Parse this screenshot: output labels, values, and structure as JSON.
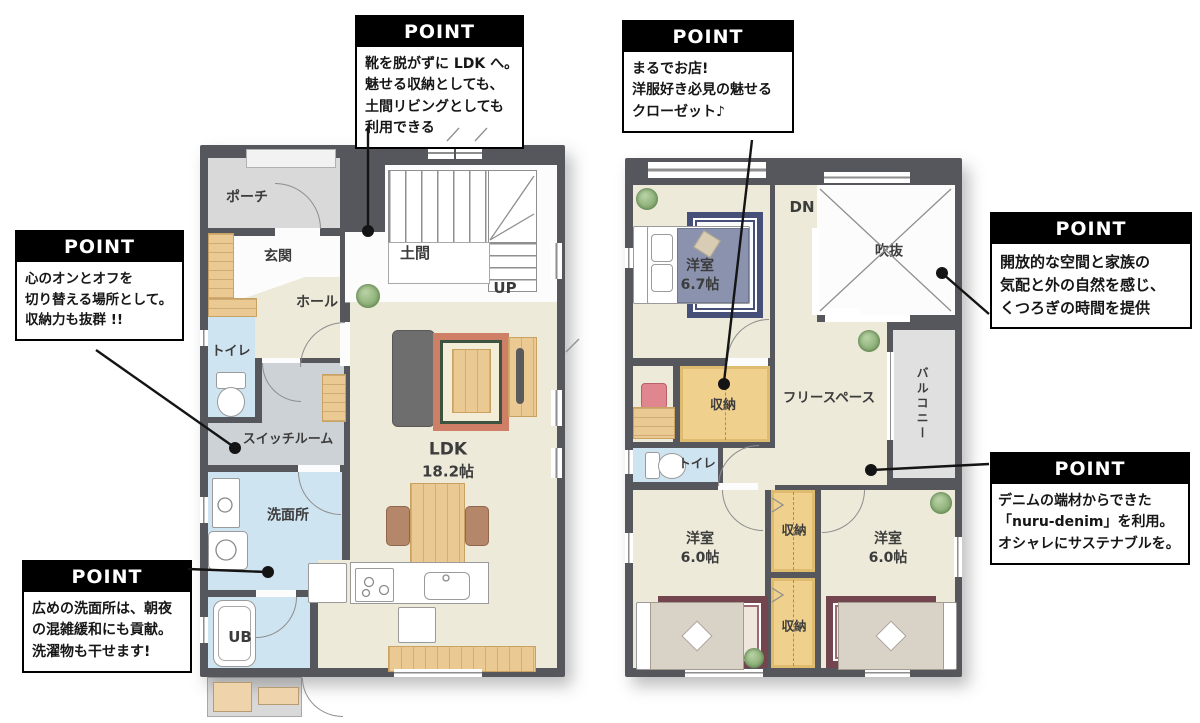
{
  "title": "2-story house floor plan",
  "floor1": {
    "labels": {
      "porch": "ポーチ",
      "genkan": "玄関",
      "doma": "土間",
      "hall": "ホール",
      "toilet": "トイレ",
      "switch_room": "スイッチルーム",
      "washroom": "洗面所",
      "ub": "UB",
      "ldk_name": "LDK",
      "ldk_size": "18.2帖",
      "up": "UP"
    }
  },
  "floor2": {
    "labels": {
      "dn": "DN",
      "void_space": "吹抜",
      "bedroom_main": "洋室",
      "bedroom_main_size": "6.7帖",
      "closet_main": "収納",
      "free_space": "フリースペース",
      "balcony": "バルコニー",
      "toilet": "トイレ",
      "bedroom_left": "洋室",
      "bedroom_left_size": "6.0帖",
      "closet_upper": "収納",
      "closet_lower": "収納",
      "bedroom_right": "洋室",
      "bedroom_right_size": "6.0帖"
    }
  },
  "callouts": [
    {
      "title": "POINT",
      "lines": [
        "靴を脱がずに LDK へ。",
        "魅せる収納としても、",
        "土間リビングとしても",
        "利用できる"
      ]
    },
    {
      "title": "POINT",
      "lines": [
        "心のオンとオフを",
        "切り替える場所として。",
        "収納力も抜群 !!"
      ]
    },
    {
      "title": "POINT",
      "lines": [
        "広めの洗面所は、朝夜",
        "の混雑緩和にも貢献。",
        "洗濯物も干せます!"
      ]
    },
    {
      "title": "POINT",
      "lines": [
        "まるでお店!",
        "洋服好き必見の魅せる",
        "クローゼット♪"
      ]
    },
    {
      "title": "POINT",
      "lines": [
        "開放的な空間と家族の",
        "気配と外の自然を感じ、",
        "くつろぎの時間を提供"
      ]
    },
    {
      "title": "POINT",
      "lines": [
        "デニムの端材からできた",
        "「nuru-denim」を利用。",
        "オシャレにサステナブルを。"
      ]
    }
  ],
  "colors": {
    "wall": "#56575c",
    "floor_cream": "#edead9",
    "floor_water": "#cfe4f1",
    "floor_porch": "#d9d9d9",
    "floor_switch": "#ccd2d6",
    "closet_tan": "#f0d08d",
    "callout_bg": "#000000",
    "callout_text": "#ffffff",
    "connector": "#141414",
    "wood": "#ebc993"
  }
}
